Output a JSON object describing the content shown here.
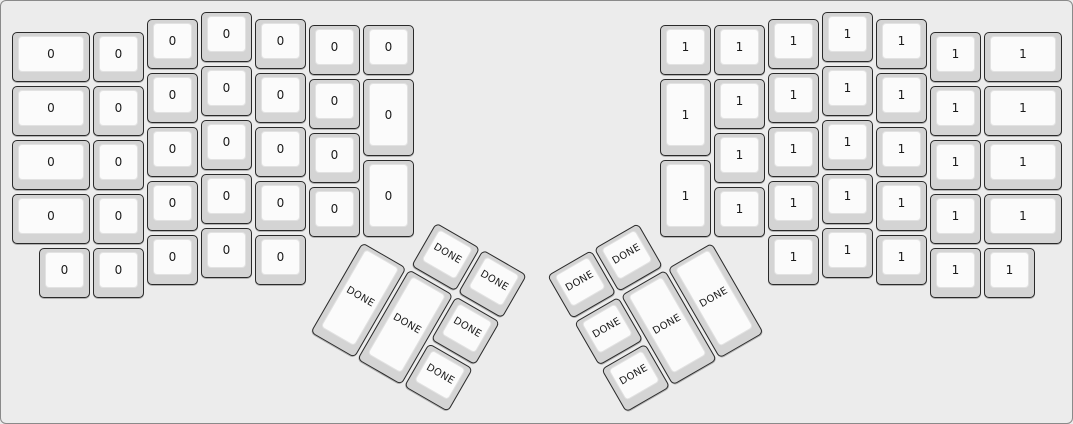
{
  "page": {
    "background_color": "#ececec",
    "border_color": "#8a8a8a"
  },
  "keyboard": {
    "name": "ergodox-split-layout",
    "unit_px": 54,
    "colors": {
      "keycap": "#d4d4d4",
      "keycap_border": "#2a2a2a",
      "keytop": "#fbfbfb",
      "keytop_border": "#e2e2e2",
      "label": "#1a1a1a"
    },
    "groups": [
      {
        "name": "left-main",
        "label": "0",
        "rotation": 0,
        "origin": [
          0,
          0
        ],
        "keys": [
          [
            10,
            30,
            81,
            54
          ],
          [
            10,
            84,
            81,
            54
          ],
          [
            10,
            138,
            81,
            54
          ],
          [
            10,
            192,
            81,
            54
          ],
          [
            91,
            30,
            54,
            54
          ],
          [
            91,
            84,
            54,
            54
          ],
          [
            91,
            138,
            54,
            54
          ],
          [
            91,
            192,
            54,
            54
          ],
          [
            145,
            17,
            54,
            54
          ],
          [
            145,
            71,
            54,
            54
          ],
          [
            145,
            125,
            54,
            54
          ],
          [
            145,
            179,
            54,
            54
          ],
          [
            199,
            10,
            54,
            54
          ],
          [
            199,
            64,
            54,
            54
          ],
          [
            199,
            118,
            54,
            54
          ],
          [
            199,
            172,
            54,
            54
          ],
          [
            253,
            17,
            54,
            54
          ],
          [
            253,
            71,
            54,
            54
          ],
          [
            253,
            125,
            54,
            54
          ],
          [
            253,
            179,
            54,
            54
          ],
          [
            307,
            23,
            54,
            54
          ],
          [
            307,
            77,
            54,
            54
          ],
          [
            307,
            131,
            54,
            54
          ],
          [
            307,
            185,
            54,
            54
          ],
          [
            361,
            23,
            54,
            54
          ],
          [
            361,
            77,
            54,
            81
          ],
          [
            361,
            158,
            54,
            81
          ],
          [
            37,
            246,
            54,
            54
          ],
          [
            91,
            246,
            54,
            54
          ],
          [
            145,
            233,
            54,
            54
          ],
          [
            199,
            226,
            54,
            54
          ],
          [
            253,
            233,
            54,
            54
          ]
        ]
      },
      {
        "name": "right-main",
        "label": "1",
        "rotation": 0,
        "origin": [
          0,
          0
        ],
        "keys": [
          [
            658,
            23,
            54,
            54
          ],
          [
            658,
            77,
            54,
            81
          ],
          [
            658,
            158,
            54,
            81
          ],
          [
            712,
            23,
            54,
            54
          ],
          [
            712,
            77,
            54,
            54
          ],
          [
            712,
            131,
            54,
            54
          ],
          [
            712,
            185,
            54,
            54
          ],
          [
            766,
            17,
            54,
            54
          ],
          [
            766,
            71,
            54,
            54
          ],
          [
            766,
            125,
            54,
            54
          ],
          [
            766,
            179,
            54,
            54
          ],
          [
            820,
            10,
            54,
            54
          ],
          [
            820,
            64,
            54,
            54
          ],
          [
            820,
            118,
            54,
            54
          ],
          [
            820,
            172,
            54,
            54
          ],
          [
            874,
            17,
            54,
            54
          ],
          [
            874,
            71,
            54,
            54
          ],
          [
            874,
            125,
            54,
            54
          ],
          [
            874,
            179,
            54,
            54
          ],
          [
            928,
            30,
            54,
            54
          ],
          [
            928,
            84,
            54,
            54
          ],
          [
            928,
            138,
            54,
            54
          ],
          [
            928,
            192,
            54,
            54
          ],
          [
            982,
            30,
            81,
            54
          ],
          [
            982,
            84,
            81,
            54
          ],
          [
            982,
            138,
            81,
            54
          ],
          [
            982,
            192,
            81,
            54
          ],
          [
            766,
            233,
            54,
            54
          ],
          [
            820,
            226,
            54,
            54
          ],
          [
            874,
            233,
            54,
            54
          ],
          [
            928,
            246,
            54,
            54
          ],
          [
            982,
            246,
            54,
            54
          ]
        ]
      },
      {
        "name": "left-thumb",
        "label": "DONE",
        "rotation": 30,
        "origin": [
          361,
          239.5
        ],
        "keys": [
          [
            54,
            -54,
            54,
            54
          ],
          [
            108,
            -54,
            54,
            54
          ],
          [
            0,
            0,
            54,
            108
          ],
          [
            54,
            0,
            54,
            108
          ],
          [
            108,
            0,
            54,
            54
          ],
          [
            108,
            54,
            54,
            54
          ]
        ]
      },
      {
        "name": "right-thumb",
        "label": "DONE",
        "rotation": -30,
        "origin": [
          712,
          239.5
        ],
        "keys": [
          [
            -108,
            -54,
            54,
            54
          ],
          [
            -162,
            -54,
            54,
            54
          ],
          [
            -54,
            0,
            54,
            108
          ],
          [
            -108,
            0,
            54,
            108
          ],
          [
            -162,
            0,
            54,
            54
          ],
          [
            -162,
            54,
            54,
            54
          ]
        ]
      }
    ]
  }
}
